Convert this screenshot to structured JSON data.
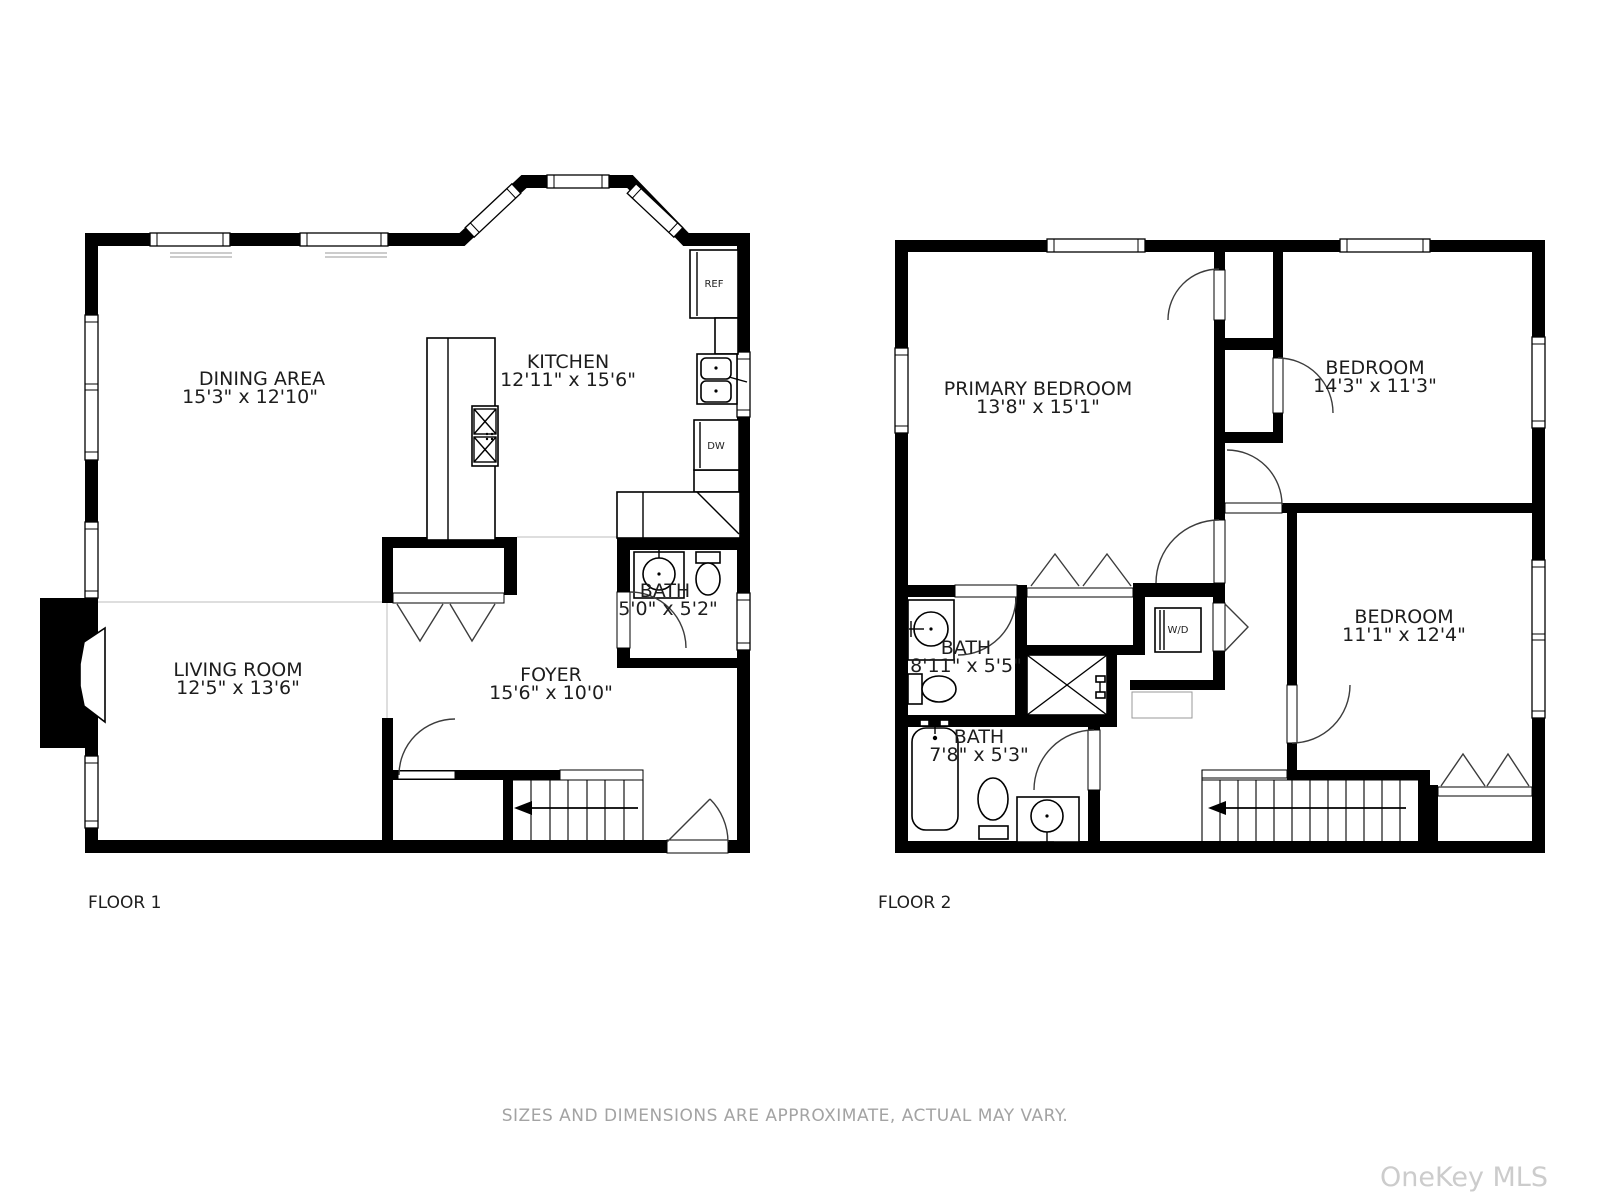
{
  "floor1": {
    "label": "FLOOR 1",
    "rooms": {
      "dining": {
        "name": "DINING AREA",
        "dims": "15'3\" x 12'10\""
      },
      "kitchen": {
        "name": "KITCHEN",
        "dims": "12'11\" x 15'6\""
      },
      "bath": {
        "name": "BATH",
        "dims": "5'0\" x 5'2\""
      },
      "living": {
        "name": "LIVING ROOM",
        "dims": "12'5\" x 13'6\""
      },
      "foyer": {
        "name": "FOYER",
        "dims": "15'6\" x 10'0\""
      }
    },
    "appliances": {
      "fridge": "REF",
      "dishwasher": "DW"
    }
  },
  "floor2": {
    "label": "FLOOR 2",
    "rooms": {
      "primary": {
        "name": "PRIMARY BEDROOM",
        "dims": "13'8\" x 15'1\""
      },
      "bedroom_tr": {
        "name": "BEDROOM",
        "dims": "14'3\" x 11'3\""
      },
      "bedroom_br": {
        "name": "BEDROOM",
        "dims": "11'1\" x 12'4\""
      },
      "bath_upper": {
        "name": "BATH",
        "dims": "8'11\" x 5'5\""
      },
      "bath_lower": {
        "name": "BATH",
        "dims": "7'8\" x 5'3\""
      }
    },
    "appliances": {
      "washer_dryer": "W/D"
    }
  },
  "footer": {
    "disclaimer": "SIZES AND DIMENSIONS ARE APPROXIMATE, ACTUAL MAY VARY."
  },
  "watermark": "OneKey MLS",
  "colors": {
    "wall": "#000000",
    "doorline": "#3c3c3c",
    "faint": "#c9c9c9",
    "label": "#1d1d1d",
    "muted": "#a3a3a3",
    "watermark": "#cccccc"
  }
}
